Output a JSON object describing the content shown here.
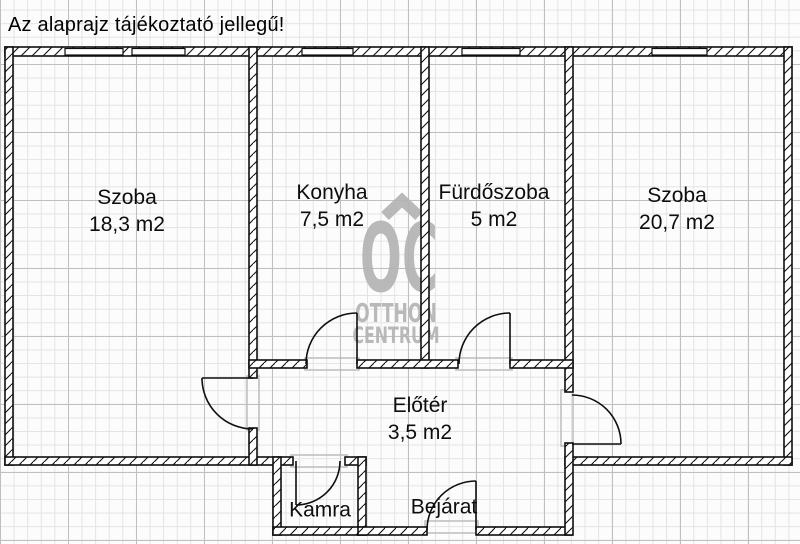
{
  "disclaimer": "Az alaprajz tájékoztató jellegű!",
  "rooms": [
    {
      "name": "Szoba",
      "area": "18,3 m2"
    },
    {
      "name": "Konyha",
      "area": "7,5 m2"
    },
    {
      "name": "Fürdőszoba",
      "area": "5 m2"
    },
    {
      "name": "Szoba",
      "area": "20,7 m2"
    },
    {
      "name": "Előtér",
      "area": "3,5 m2"
    },
    {
      "name": "Kamra"
    },
    {
      "name": "Bejárat"
    }
  ],
  "watermark": {
    "logo_text": "OC",
    "line1": "OTTHON",
    "line2": "CENTRUM",
    "color": "#b4b4b4"
  },
  "colors": {
    "wall": "#0f0f0f",
    "grid_minor": "#e3e3e3",
    "grid_major": "#bfbfbf",
    "background": "#fcfcfc",
    "threshold_gray": "#bcbcbc"
  }
}
